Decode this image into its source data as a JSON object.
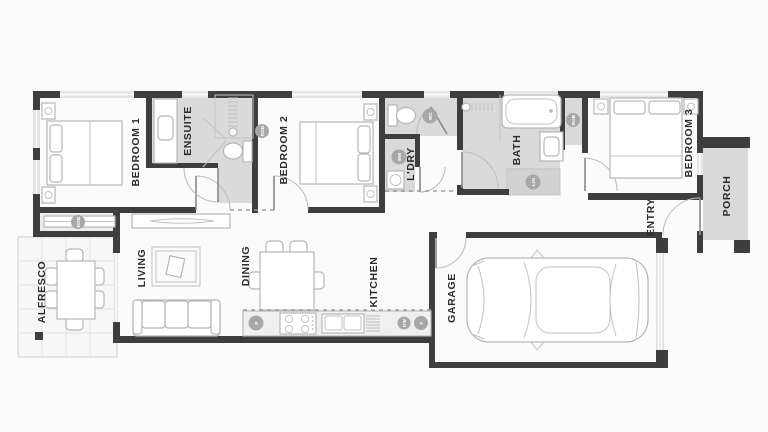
{
  "plan_title": "single-storey house floor plan",
  "colors": {
    "wall": "#3e3e3e",
    "wet_area_floor": "#dadada",
    "background": "#fbfbfb",
    "furniture_stroke": "#b6b6b6",
    "label_text": "#2b2b2b",
    "marker_fill": "#a7a7a7"
  },
  "rooms": {
    "bedroom1": {
      "label": "BEDROOM 1"
    },
    "ensuite": {
      "label": "ENSUITE"
    },
    "bedroom2": {
      "label": "BEDROOM 2"
    },
    "ldry": {
      "label": "L'DRY"
    },
    "bath": {
      "label": "BATH"
    },
    "bedroom3": {
      "label": "BEDROOM 3"
    },
    "porch": {
      "label": "PORCH"
    },
    "entry": {
      "label": "ENTRY"
    },
    "alfresco": {
      "label": "ALFRESCO"
    },
    "living": {
      "label": "LIVING"
    },
    "dining": {
      "label": "DINING"
    },
    "kitchen": {
      "label": "KITCHEN"
    },
    "garage": {
      "label": "GARAGE"
    }
  },
  "markers": {
    "rob_bedroom1": {
      "label": "ROB"
    },
    "rob_bedroom2": {
      "label": "ROB"
    },
    "wc": {
      "label": "WC"
    },
    "wm": {
      "label": "WM"
    },
    "lin": {
      "label": "LIN"
    },
    "rob_bedroom3": {
      "label": "ROB"
    },
    "pantry": {
      "label": "P"
    },
    "dishwasher": {
      "label": "DW"
    },
    "fridge": {
      "label": "F"
    }
  }
}
